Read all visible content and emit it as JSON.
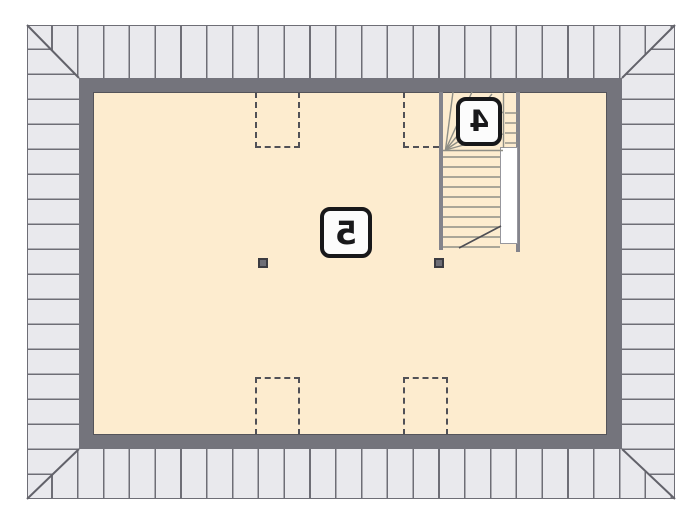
{
  "plan": {
    "labels": {
      "room": "5",
      "staircase": "4"
    },
    "colors": {
      "background": "#FFFFFF",
      "roof_fill": "#E9E9ED",
      "roof_line": "#6E6E76",
      "wall": "#74747C",
      "interior_fill": "#FDECCF",
      "stair_line": "#8E8E86",
      "dashed_outline": "#515157",
      "column": "#6E6E76",
      "label_border": "#18181A"
    }
  }
}
